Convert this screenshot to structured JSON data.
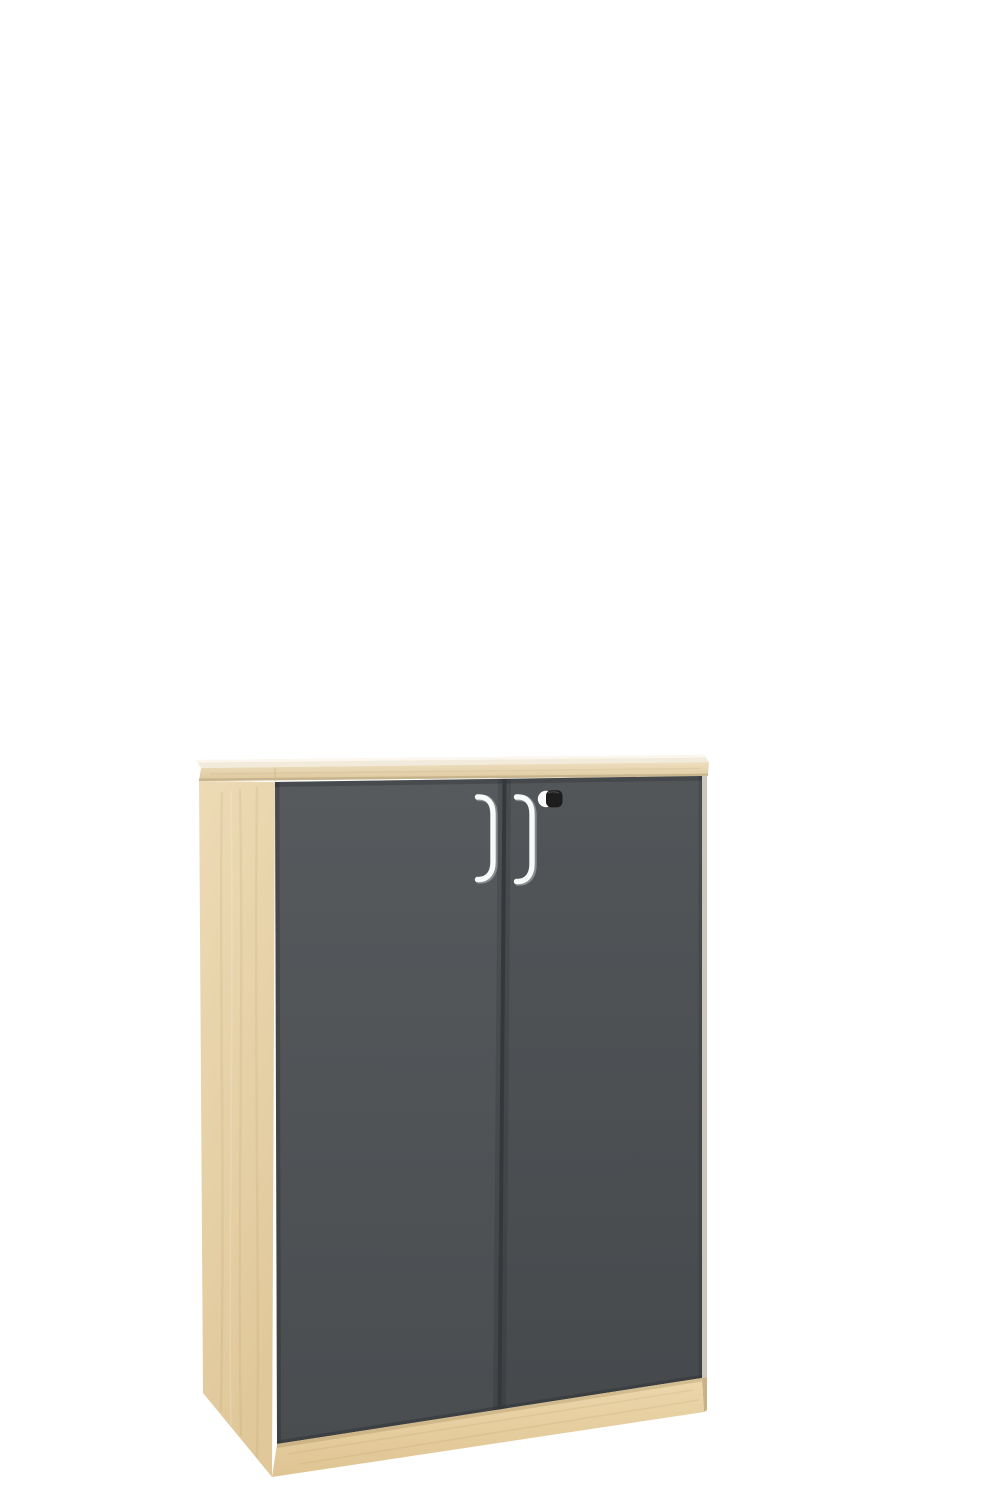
{
  "meta": {
    "type": "product-photo",
    "subject": "Two-door office storage cabinet rendered on a plain white background, viewed from the front-left and slightly above",
    "materials": "Maple / light-wood carcass, top panel and plinth; anthracite grey doors; white bow handles; black cylinder lock on right door"
  },
  "object": {
    "name": "two-door-cabinet",
    "door_count": "2",
    "handle_count": "2",
    "lock_count": "1"
  },
  "colors": {
    "background": "#ffffff",
    "top_surface": "#f2ebdb",
    "top_surface_highlight": "#fbf7ee",
    "top_edge_light": "#eedfc0",
    "top_edge_dark": "#ddc79b",
    "top_edge_line": "#c2b089",
    "side_light": "#eddbb6",
    "side_dark": "#e0c89a",
    "door_top": "#565a5d",
    "door_bottom": "#494d50",
    "door_gap": "#35383a",
    "plinth_light": "#ecd7ab",
    "plinth_dark": "#dfc493",
    "plinth_side": "#c8b286",
    "right_edge": "#cbc7bc",
    "grain": "#a98a52",
    "handle_white": "#f8f9f9",
    "handle_shadow": "#8d9295",
    "lock_body": "#1d1d1d",
    "lock_highlight": "#fbfbfb"
  }
}
